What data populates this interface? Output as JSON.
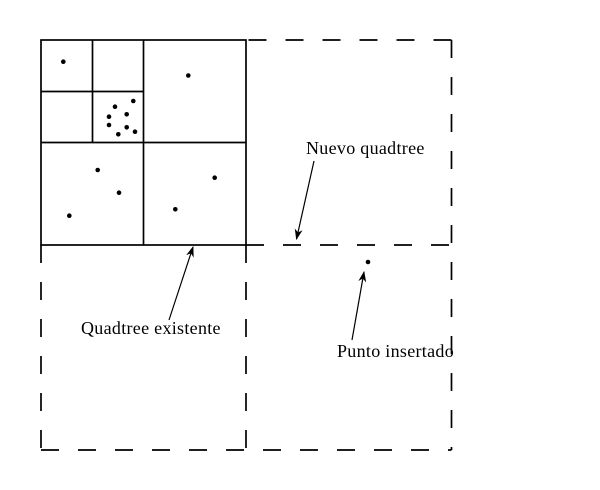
{
  "figure": {
    "description": "Quadtree insertion diagram",
    "background_color": "#ffffff",
    "line_color": "#000000"
  },
  "labels": {
    "nuevo_quadtree": "Nuevo quadtree",
    "quadtree_existente": "Quadtree existente",
    "punto_insertado": "Punto insertado"
  },
  "points": {
    "radius": 2.3,
    "existing_quadtree": [
      [
        63.3,
        61.7
      ],
      [
        188.3,
        75.5
      ],
      [
        115.0,
        106.7
      ],
      [
        133.3,
        101.0
      ],
      [
        126.7,
        114.3
      ],
      [
        109.0,
        116.7
      ],
      [
        109.0,
        125.0
      ],
      [
        126.7,
        127.3
      ],
      [
        135.0,
        131.7
      ],
      [
        118.3,
        134.3
      ],
      [
        97.7,
        170.0
      ],
      [
        119.0,
        192.7
      ],
      [
        69.3,
        215.7
      ],
      [
        214.7,
        177.7
      ],
      [
        175.3,
        209.3
      ]
    ],
    "inserted": [
      368.0,
      262.0
    ]
  }
}
